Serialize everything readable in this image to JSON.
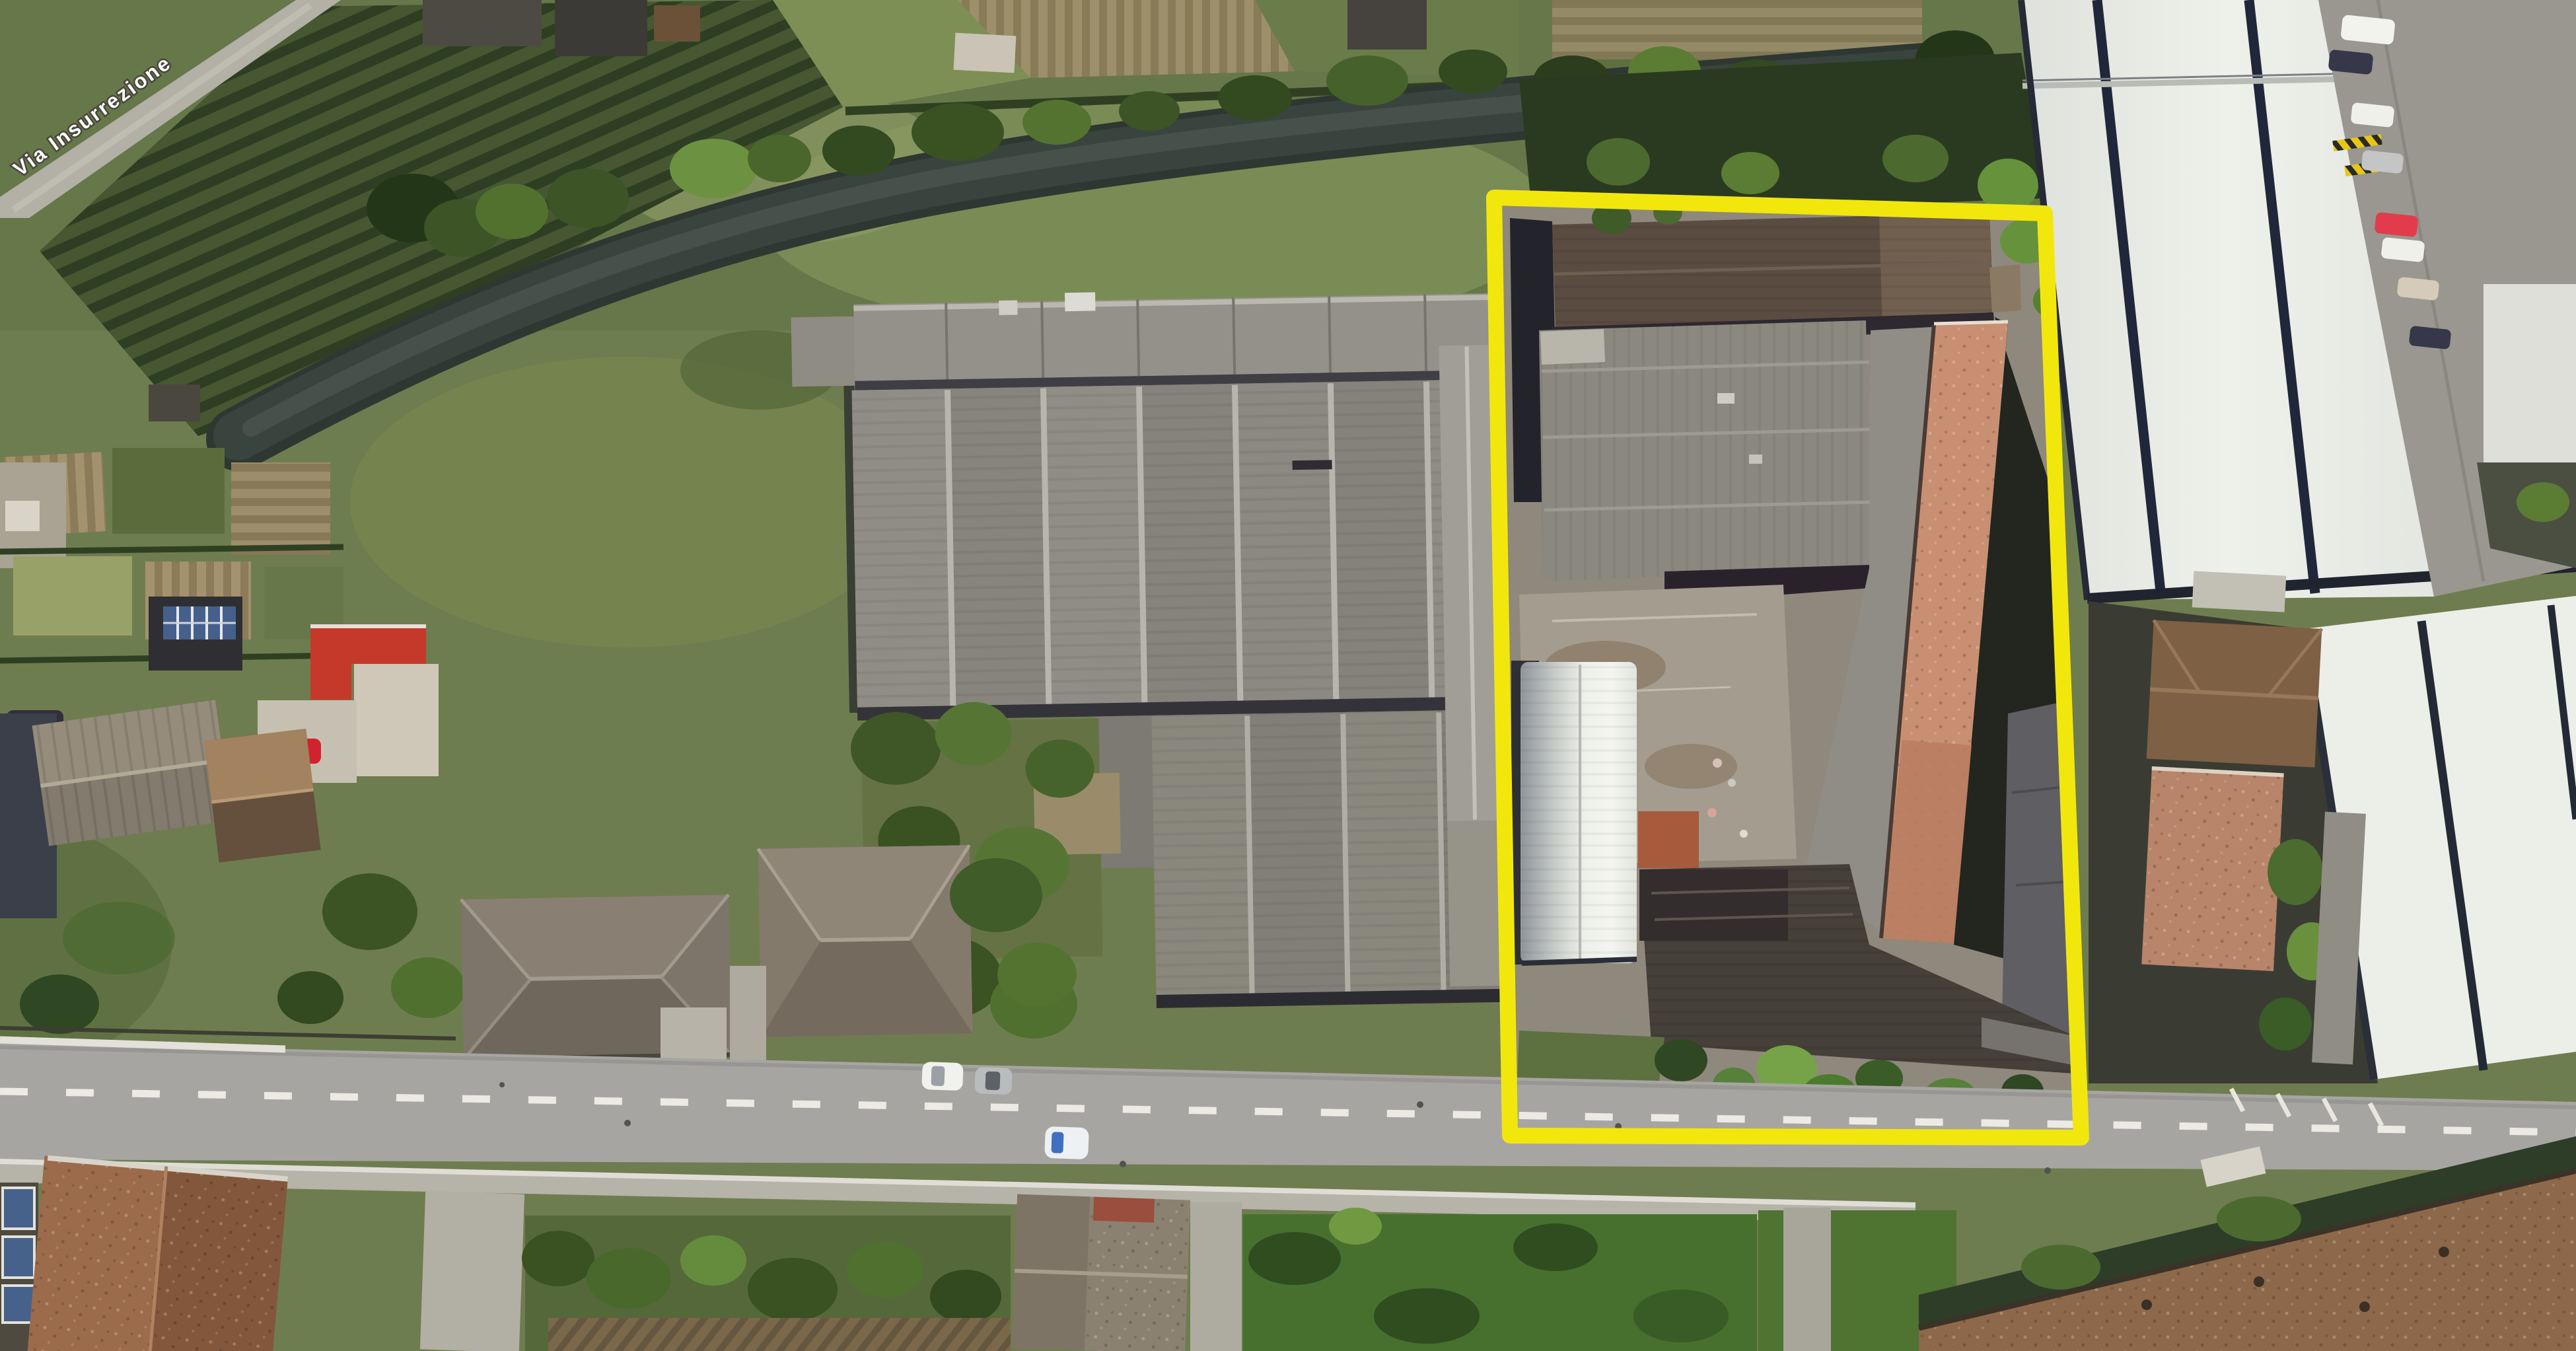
{
  "map": {
    "road_label": "Via Insurrezione",
    "highlight_color": "#f2e70c",
    "lane_marking_color": "#eceae2"
  },
  "vehicles": {
    "road_white_car": "#f1f1ed",
    "road_silver_car": "#b9bcbd",
    "road_moving_car_body": "#eef1f4",
    "road_moving_car_glass": "#3f6fc2",
    "driveway_red_car": "#d0232e",
    "parked_dark_car": "#322e3a",
    "parking_white_van": "#f3f3ee",
    "parking_red_car": "#e23c4c",
    "parking_beige_car": "#d6cbb8",
    "parking_silver_car": "#c4c6c5",
    "parking_dark_car": "#363748",
    "parking_white_car": "#eff0ea"
  }
}
